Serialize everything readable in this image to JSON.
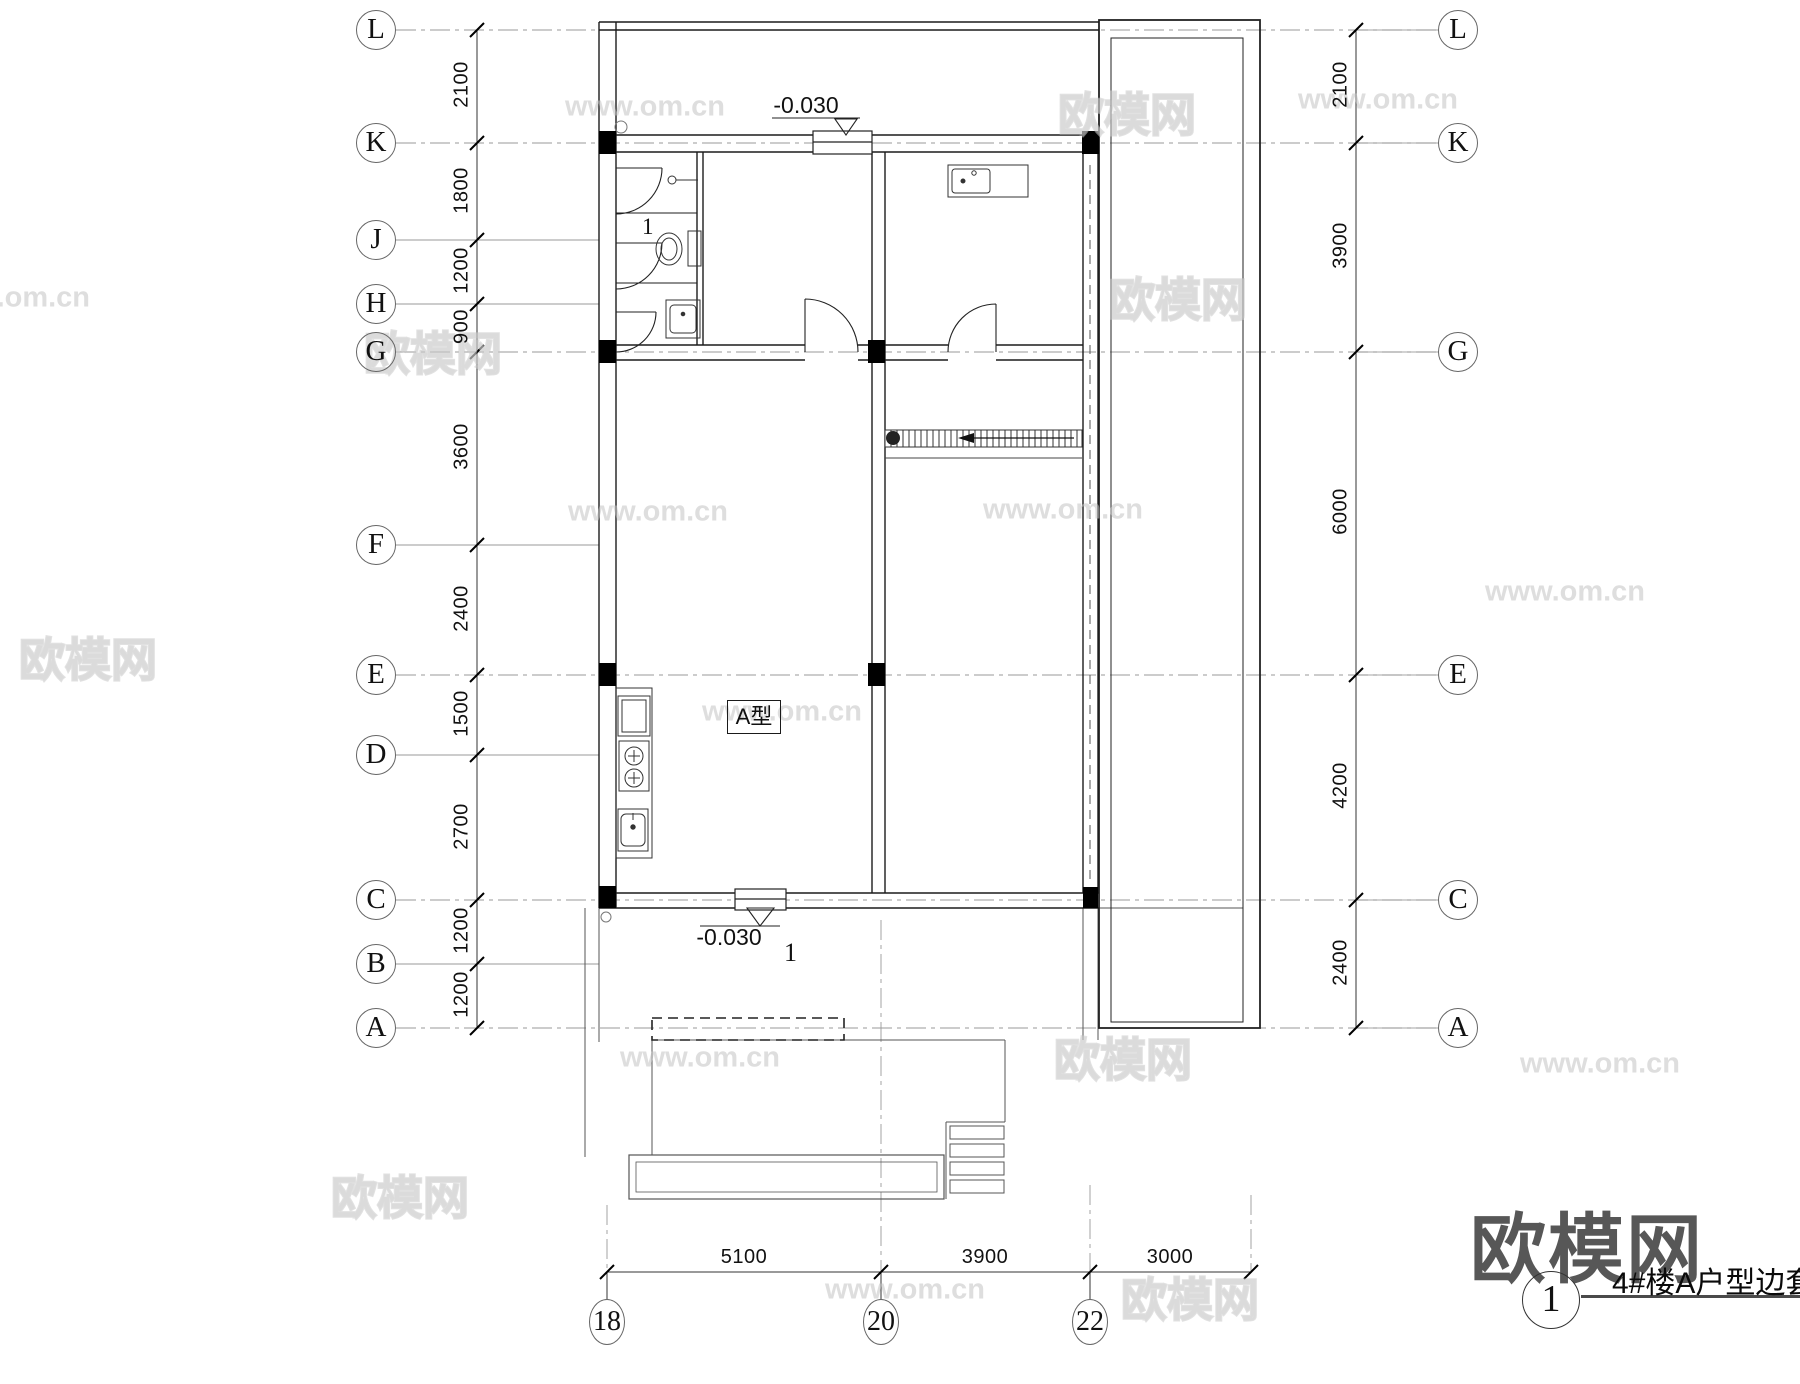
{
  "watermark": {
    "site_name": "欧模网",
    "site_url": "www.om.cn"
  },
  "title_block": {
    "logo_text": "欧模网",
    "sheet_number": "1",
    "drawing_title": "4#楼A户型边套"
  },
  "plan_labels": {
    "unit_type": "A型",
    "elevation_top": "-0.030",
    "elevation_bottom": "-0.030",
    "entry_number": "1",
    "bathroom_number": "1"
  },
  "grid": {
    "left_axes": [
      "L",
      "K",
      "J",
      "H",
      "G",
      "F",
      "E",
      "D",
      "C",
      "B",
      "A"
    ],
    "left_dims": [
      "2100",
      "1800",
      "1200",
      "900",
      "3600",
      "2400",
      "1500",
      "2700",
      "1200",
      "1200"
    ],
    "right_axes": [
      "L",
      "K",
      "G",
      "E",
      "C",
      "A"
    ],
    "right_dims": [
      "2100",
      "3900",
      "6000",
      "4200",
      "2400"
    ],
    "bottom_axes": [
      "18",
      "20",
      "22"
    ],
    "bottom_dims": [
      "5100",
      "3900",
      "3000"
    ]
  }
}
